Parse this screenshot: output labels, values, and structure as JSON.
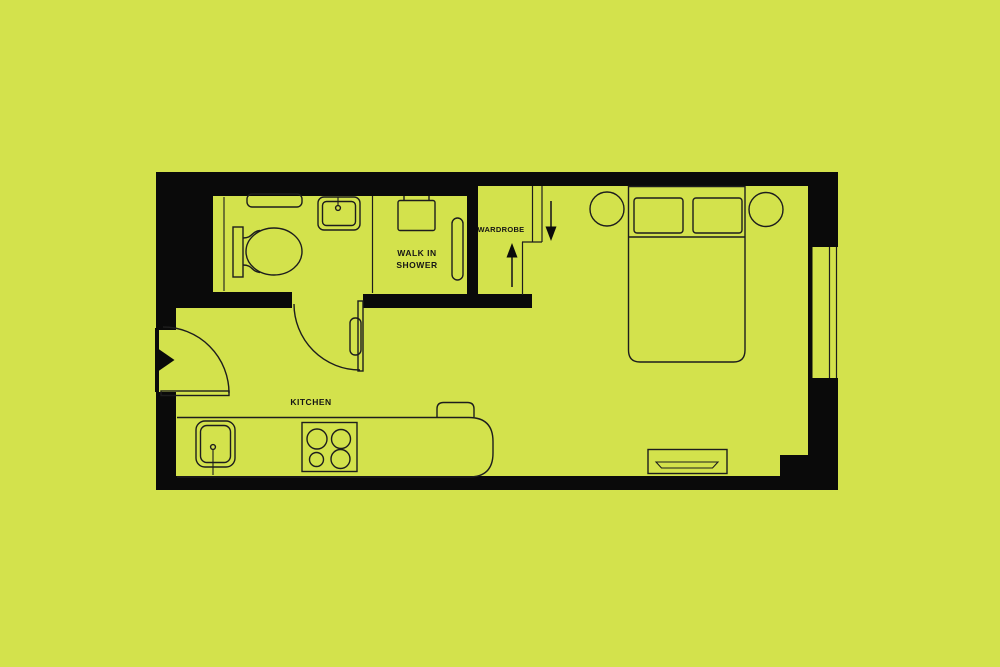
{
  "colors": {
    "background": "#d3e24c",
    "wall": "#0a0a0a",
    "line": "#1d1d1d",
    "text": "#151515"
  },
  "labels": {
    "walk_in_shower": "WALK IN\nSHOWER",
    "wardrobe": "WARDROBE",
    "kitchen": "KITCHEN"
  }
}
